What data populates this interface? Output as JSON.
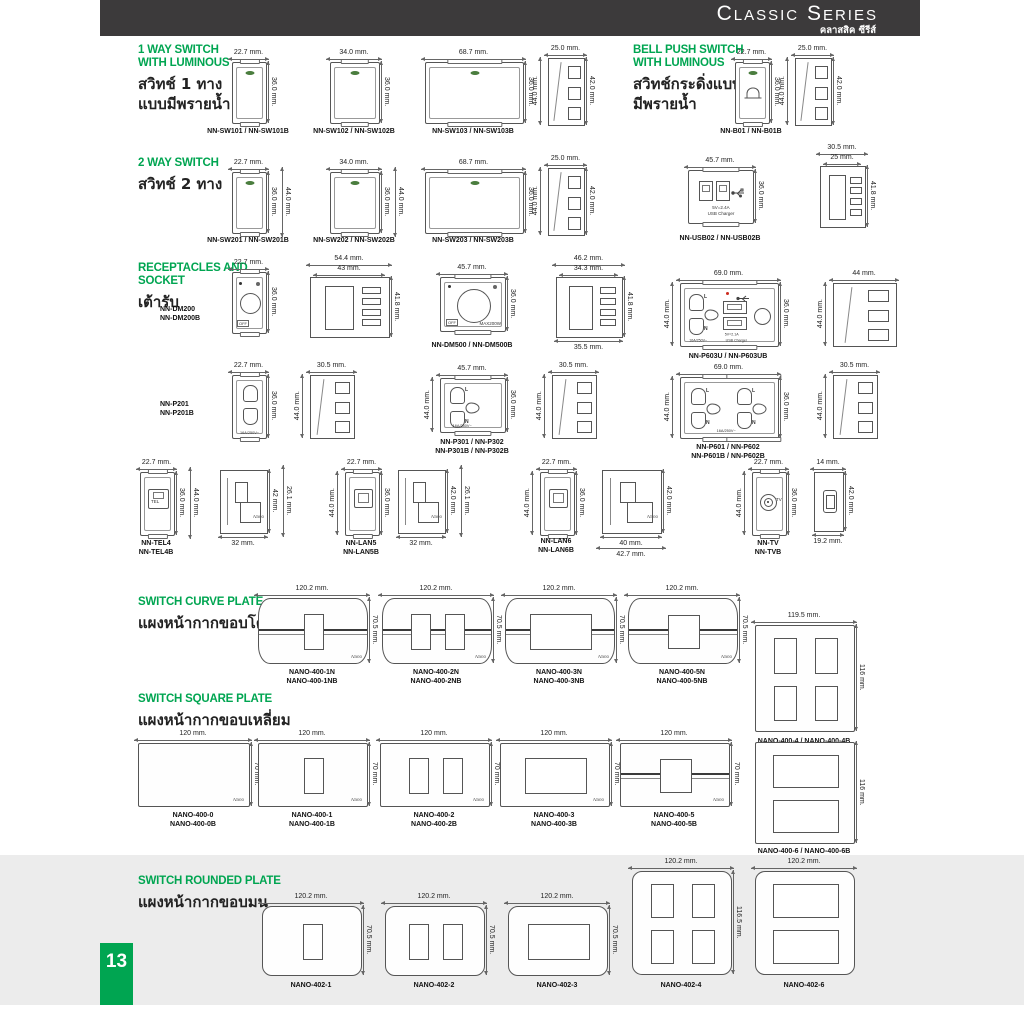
{
  "header": {
    "title": "Classic Series",
    "thai": "คลาสสิค ซีรีส์"
  },
  "page_number": "13",
  "brand": {
    "nano": "Nano"
  },
  "labels": {
    "off": "OFF",
    "max": "MAX200W",
    "l": "L",
    "n": "N",
    "rating": "16A/250V~",
    "usb_line1": "5V=2.4A",
    "usb_line2": "USB Charger",
    "usb603_line1": "5V=2.1A",
    "usb603_line2": "USB Charger",
    "tel": "TEL",
    "tv": "TV"
  },
  "sections": [
    {
      "id": "one-way-switch",
      "title": "1 WAY SWITCH\nWITH LUMINOUS",
      "thai": "สวิทช์ 1 ทาง\nแบบมีพรายน้ำ"
    },
    {
      "id": "bell-push-switch",
      "title": "BELL PUSH SWITCH\nWITH LUMINOUS",
      "thai": "สวิทช์กระดิ่งแบบ\nมีพรายน้ำ"
    },
    {
      "id": "two-way-switch",
      "title": "2 WAY SWITCH",
      "thai": "สวิทช์ 2 ทาง"
    },
    {
      "id": "receptacles-socket",
      "title": "RECEPTACLES AND\nSOCKET",
      "thai": "เต้ารับ"
    },
    {
      "id": "switch-curve-plate",
      "title": "SWITCH CURVE PLATE",
      "thai": "แผงหน้ากากขอบโค้ง"
    },
    {
      "id": "switch-square-plate",
      "title": "SWITCH SQUARE PLATE",
      "thai": "แผงหน้ากากขอบเหลี่ยม"
    },
    {
      "id": "switch-rounded-plate",
      "title": "SWITCH ROUNDED  PLATE",
      "thai": "แผงหน้ากากขอบมน"
    }
  ],
  "figures": [
    {
      "model_lines": [
        "NN-SW101 / NN-SW101B"
      ],
      "dims": {
        "top": "22.7 mm.",
        "right": "36.0 mm."
      }
    },
    {
      "model_lines": [
        "NN-SW102 / NN-SW102B"
      ],
      "dims": {
        "top": "34.0 mm.",
        "right": "36.0 mm."
      }
    },
    {
      "model_lines": [
        "NN-SW103 / NN-SW103B"
      ],
      "dims": {
        "top": "68.7 mm.",
        "right": "36.0 mm."
      }
    },
    {
      "model_lines": [],
      "dims": {
        "top": "25.0 mm.",
        "left": "44.0 mm.",
        "right": "42.0 mm."
      }
    },
    {
      "model_lines": [
        "NN-B01 / NN-B01B"
      ],
      "dims": {
        "top": "22.7 mm.",
        "right": "36.0 mm."
      }
    },
    {
      "model_lines": [],
      "dims": {
        "top": "25.0 mm.",
        "left": "44.0 mm.",
        "right": "42.0 mm."
      }
    },
    {
      "model_lines": [
        "NN-SW201 / NN-SW201B"
      ],
      "dims": {
        "top": "22.7 mm.",
        "right": "36.0 mm.",
        "right2": "44.0 mm."
      }
    },
    {
      "model_lines": [
        "NN-SW202 / NN-SW202B"
      ],
      "dims": {
        "top": "34.0 mm.",
        "right": "36.0 mm.",
        "right2": "44.0 mm."
      }
    },
    {
      "model_lines": [
        "NN-SW203 / NN-SW203B"
      ],
      "dims": {
        "top": "68.7 mm.",
        "right": "36.0 mm."
      }
    },
    {
      "model_lines": [],
      "dims": {
        "top": "25.0 mm.",
        "left": "44.0 mm.",
        "right": "42.0 mm."
      }
    },
    {
      "model_lines": [
        "NN-USB02 / NN-USB02B"
      ],
      "dims": {
        "top": "45.7 mm.",
        "right": "36.0 mm."
      }
    },
    {
      "model_lines": [],
      "dims": {
        "top": "30.5 mm.",
        "top2": "25 mm.",
        "right": "41.8 mm."
      }
    },
    {
      "model_lines": [
        "NN-DM200",
        "NN-DM200B"
      ],
      "dims": {
        "top": "22.7 mm.",
        "right": "36.0 mm."
      }
    },
    {
      "model_lines": [],
      "dims": {
        "top": "54.4 mm.",
        "top2": "43 mm.",
        "right": "41.8 mm."
      }
    },
    {
      "model_lines": [
        "NN-DM500 / NN-DM500B"
      ],
      "dims": {
        "top": "45.7 mm.",
        "right": "36.0 mm."
      }
    },
    {
      "model_lines": [],
      "dims": {
        "top": "46.2 mm.",
        "top2": "34.3 mm.",
        "right": "41.8 mm.",
        "bottom": "35.5 mm."
      }
    },
    {
      "model_lines": [
        "NN-P603U / NN-P603UB"
      ],
      "dims": {
        "top": "69.0 mm.",
        "left": "44.0 mm.",
        "right": "36.0 mm."
      }
    },
    {
      "model_lines": [],
      "dims": {
        "top": "44 mm.",
        "left": "44.0 mm."
      }
    },
    {
      "model_lines": [
        "NN-P201",
        "NN-P201B"
      ],
      "dims": {
        "top": "22.7 mm.",
        "right": "36.0 mm."
      }
    },
    {
      "model_lines": [],
      "dims": {
        "top": "30.5 mm.",
        "left": "44.0 mm."
      }
    },
    {
      "model_lines": [
        "NN-P301  /  NN-P302",
        "NN-P301B / NN-P302B"
      ],
      "dims": {
        "top": "45.7 mm.",
        "left": "44.0 mm.",
        "right": "36.0 mm."
      }
    },
    {
      "model_lines": [],
      "dims": {
        "top": "30.5 mm.",
        "left": "44.0 mm."
      }
    },
    {
      "model_lines": [
        "NN-P601  /  NN-P602",
        "NN-P601B / NN-P602B"
      ],
      "dims": {
        "top": "69.0 mm.",
        "left": "44.0 mm.",
        "right": "36.0 mm."
      }
    },
    {
      "model_lines": [],
      "dims": {
        "top": "30.5 mm.",
        "left": "44.0 mm."
      }
    },
    {
      "model_lines": [
        "NN-TEL4",
        "NN-TEL4B"
      ],
      "dims": {
        "top": "22.7 mm.",
        "right": "36.0 mm.",
        "right2": "44.0 mm."
      }
    },
    {
      "model_lines": [],
      "dims": {
        "right": "42 mm.",
        "right2": "26.1 mm.",
        "bottom": "32 mm."
      }
    },
    {
      "model_lines": [
        "NN-LAN5",
        "NN-LAN5B"
      ],
      "dims": {
        "top": "22.7 mm.",
        "left": "44.0 mm.",
        "right": "36.0 mm."
      }
    },
    {
      "model_lines": [],
      "dims": {
        "right": "42.0 mm.",
        "right2": "26.1 mm.",
        "bottom": "32 mm."
      }
    },
    {
      "model_lines": [
        "NN-LAN6",
        "NN-LAN6B"
      ],
      "dims": {
        "top": "22.7 mm.",
        "left": "44.0 mm.",
        "right": "36.0 mm."
      }
    },
    {
      "model_lines": [],
      "dims": {
        "right": "42.0 mm.",
        "bottom": "40 mm.",
        "bottom2": "42.7 mm."
      }
    },
    {
      "model_lines": [
        "NN-TV",
        "NN-TVB"
      ],
      "dims": {
        "top": "22.7 mm.",
        "left": "44.0 mm.",
        "right": "36.0 mm."
      }
    },
    {
      "model_lines": [],
      "dims": {
        "top": "14 mm.",
        "right": "42.0 mm.",
        "bottom": "19.2 mm."
      }
    },
    {
      "model_lines": [
        "NANO-400-1N",
        "NANO-400-1NB"
      ],
      "dims": {
        "top": "120.2 mm.",
        "right": "70.5 mm."
      }
    },
    {
      "model_lines": [
        "NANO-400-2N",
        "NANO-400-2NB"
      ],
      "dims": {
        "top": "120.2 mm.",
        "right": "70.5 mm."
      }
    },
    {
      "model_lines": [
        "NANO-400-3N",
        "NANO-400-3NB"
      ],
      "dims": {
        "top": "120.2 mm.",
        "right": "70.5 mm."
      }
    },
    {
      "model_lines": [
        "NANO-400-5N",
        "NANO-400-5NB"
      ],
      "dims": {
        "top": "120.2 mm.",
        "right": "70.5 mm."
      }
    },
    {
      "model_lines": [
        "NANO-400-4 / NANO-400-4B"
      ],
      "dims": {
        "top": "119.5 mm.",
        "right": "116 mm."
      }
    },
    {
      "model_lines": [
        "NANO-400-0",
        "NANO-400-0B"
      ],
      "dims": {
        "top": "120 mm.",
        "right": "70 mm."
      }
    },
    {
      "model_lines": [
        "NANO-400-1",
        "NANO-400-1B"
      ],
      "dims": {
        "top": "120 mm.",
        "right": "70 mm."
      }
    },
    {
      "model_lines": [
        "NANO-400-2",
        "NANO-400-2B"
      ],
      "dims": {
        "top": "120 mm.",
        "right": "70 mm."
      }
    },
    {
      "model_lines": [
        "NANO-400-3",
        "NANO-400-3B"
      ],
      "dims": {
        "top": "120 mm.",
        "right": "70 mm."
      }
    },
    {
      "model_lines": [
        "NANO-400-5",
        "NANO-400-5B"
      ],
      "dims": {
        "top": "120 mm.",
        "right": "70 mm."
      }
    },
    {
      "model_lines": [
        "NANO-400-6 / NANO-400-6B"
      ],
      "dims": {
        "right": "116 mm."
      }
    },
    {
      "model_lines": [
        "NANO-402-1"
      ],
      "dims": {
        "top": "120.2 mm.",
        "right": "70.5 mm."
      }
    },
    {
      "model_lines": [
        "NANO-402-2"
      ],
      "dims": {
        "top": "120.2 mm.",
        "right": "70.5 mm."
      }
    },
    {
      "model_lines": [
        "NANO-402-3"
      ],
      "dims": {
        "top": "120.2 mm.",
        "right": "70.5 mm."
      }
    },
    {
      "model_lines": [
        "NANO-402-4"
      ],
      "dims": {
        "top": "120.2 mm.",
        "right": "116.5 mm."
      }
    },
    {
      "model_lines": [
        "NANO-402-6"
      ],
      "dims": {
        "top": "120.2 mm."
      }
    }
  ]
}
